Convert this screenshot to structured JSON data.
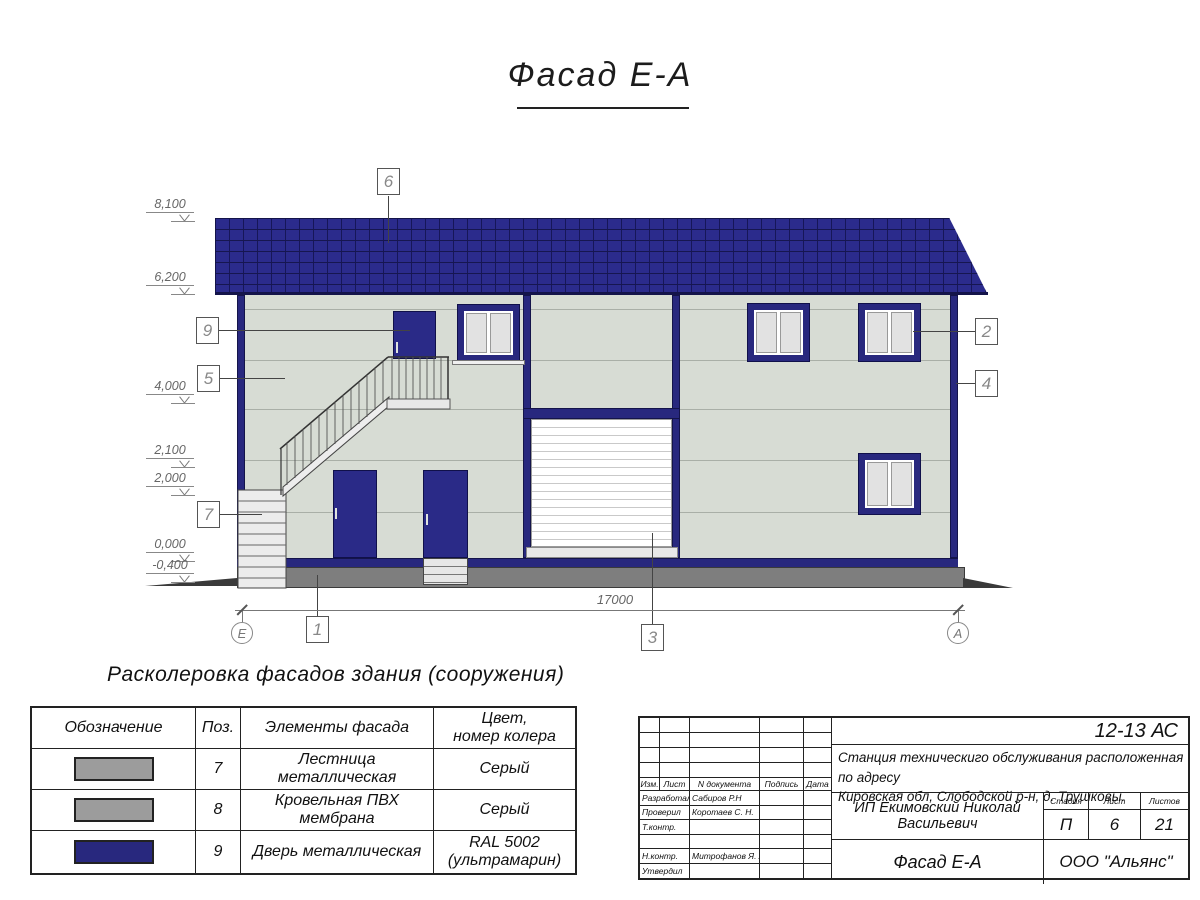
{
  "title": "Фасад Е-А",
  "drawing": {
    "elevation_marks": [
      {
        "label": "8,100"
      },
      {
        "label": "6,200"
      },
      {
        "label": "4,000"
      },
      {
        "label": "2,100"
      },
      {
        "label": "2,000"
      },
      {
        "label": "0,000"
      },
      {
        "label": "-0,400"
      }
    ],
    "callouts": [
      {
        "num": "6"
      },
      {
        "num": "9"
      },
      {
        "num": "5"
      },
      {
        "num": "7"
      },
      {
        "num": "2"
      },
      {
        "num": "4"
      },
      {
        "num": "1"
      },
      {
        "num": "3"
      }
    ],
    "axes": [
      {
        "label": "Е"
      },
      {
        "label": "А"
      }
    ],
    "dimension_mm": "17000",
    "colors": {
      "roof": "#2B2B8C",
      "facade_panel": "#D7DCD4",
      "plinth": "#7E7E7E",
      "ultramarine": "#28287E",
      "garage_door": "#FFFFFF"
    }
  },
  "legend": {
    "heading": "Расколеровка фасадов здания (сооружения)",
    "headers": {
      "designation": "Обозначение",
      "pos": "Поз.",
      "element": "Элементы фасада",
      "color_line1": "Цвет,",
      "color_line2": "номер колера"
    },
    "rows": [
      {
        "pos": "7",
        "element": "Лестница металлическая",
        "color_line1": "Серый",
        "color_line2": "",
        "swatch": "#9C9C9C"
      },
      {
        "pos": "8",
        "element": "Кровельная ПВХ мембрана",
        "color_line1": "Серый",
        "color_line2": "",
        "swatch": "#9C9C9C"
      },
      {
        "pos": "9",
        "element": "Дверь металлическая",
        "color_line1": "RAL 5002",
        "color_line2": "(ультрамарин)",
        "swatch": "#28287E"
      }
    ]
  },
  "stamp": {
    "code": "12-13 АС",
    "project_line1": "Станция техническиго обслуживания расположенная по адресу",
    "project_line2": "Кировская обл, Слободской р-н, д. Трушковы.",
    "client": "ИП Екимовский Николай Васильевич",
    "doc_title": "Фасад Е-А",
    "org": "ООО \"Альянс\"",
    "cols": {
      "izm": "Изм.",
      "list": "Лист",
      "ndoc": "N документа",
      "sign": "Подпись",
      "date": "Дата"
    },
    "roles": [
      {
        "role": "Разработал",
        "name": "Сабиров Р.Н"
      },
      {
        "role": "Проверил",
        "name": "Коротаев С. Н."
      },
      {
        "role": "Т.контр.",
        "name": ""
      },
      {
        "role": "",
        "name": ""
      },
      {
        "role": "Н.контр.",
        "name": "Митрофанов Я. А."
      },
      {
        "role": "Утвердил",
        "name": ""
      }
    ],
    "stage_label": "Стадия",
    "sheet_label": "Лист",
    "sheets_label": "Листов",
    "stage": "П",
    "sheet": "6",
    "sheets": "21"
  }
}
